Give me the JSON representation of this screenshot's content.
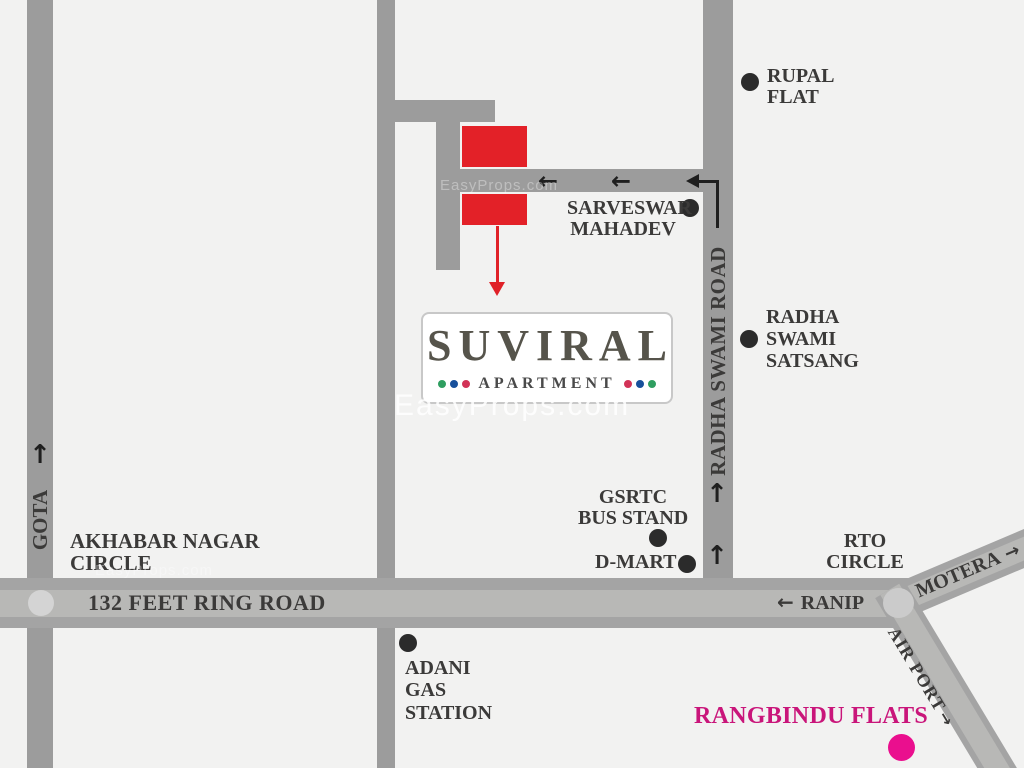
{
  "map": {
    "watermark": {
      "text": "EasyProps.com"
    },
    "logo": {
      "name": "SUVIRAL",
      "subtitle": "APARTMENT",
      "dots_left": [
        "#2f9e60",
        "#17509b",
        "#d23357"
      ],
      "dots_right": [
        "#d23357",
        "#17509b",
        "#2f9e60"
      ]
    },
    "arrows": {
      "left": "←",
      "up": "↑",
      "right": "→"
    },
    "roads": {
      "gota": {
        "label": "GOTA"
      },
      "radha_swami": {
        "label": "RADHA SWAMI ROAD"
      },
      "ring_road": {
        "label": "132 FEET RING ROAD"
      },
      "ranip": {
        "label": "RANIP"
      },
      "motera": {
        "label": "MOTERA"
      },
      "airport": {
        "label": "AIR PORT"
      }
    },
    "landmarks": {
      "rupal_flat": {
        "line1": "RUPAL",
        "line2": "FLAT"
      },
      "sarveswar_mahadev": {
        "line1": "SARVESWAR",
        "line2": "MAHADEV"
      },
      "radha_swami_satsang": {
        "line1": "RADHA",
        "line2": "SWAMI",
        "line3": "SATSANG"
      },
      "gsrtc_bus_stand": {
        "line1": "GSRTC",
        "line2": "BUS STAND"
      },
      "dmart": {
        "label": "D-MART"
      },
      "akhabar_nagar_circle": {
        "line1": "AKHABAR NAGAR",
        "line2": "CIRCLE"
      },
      "adani_gas_station": {
        "line1": "ADANI",
        "line2": "GAS",
        "line3": "STATION"
      },
      "rto_circle": {
        "line1": "RTO",
        "line2": "CIRCLE"
      },
      "rangbindu_flats": {
        "label": "RANGBINDU FLATS"
      }
    },
    "colors": {
      "background": "#f2f2f1",
      "road": "#9c9c9c",
      "road_band_dark": "#a4a4a4",
      "road_band_light": "#b8b8b6",
      "label_text": "#3b3a39",
      "building_red": "#e32128",
      "pointer_red": "#e02128",
      "magenta_text": "#c9157a",
      "magenta_dot": "#ea0f8e",
      "landmark_dot": "#2b2b2b",
      "logo_title": "#56544b"
    }
  }
}
